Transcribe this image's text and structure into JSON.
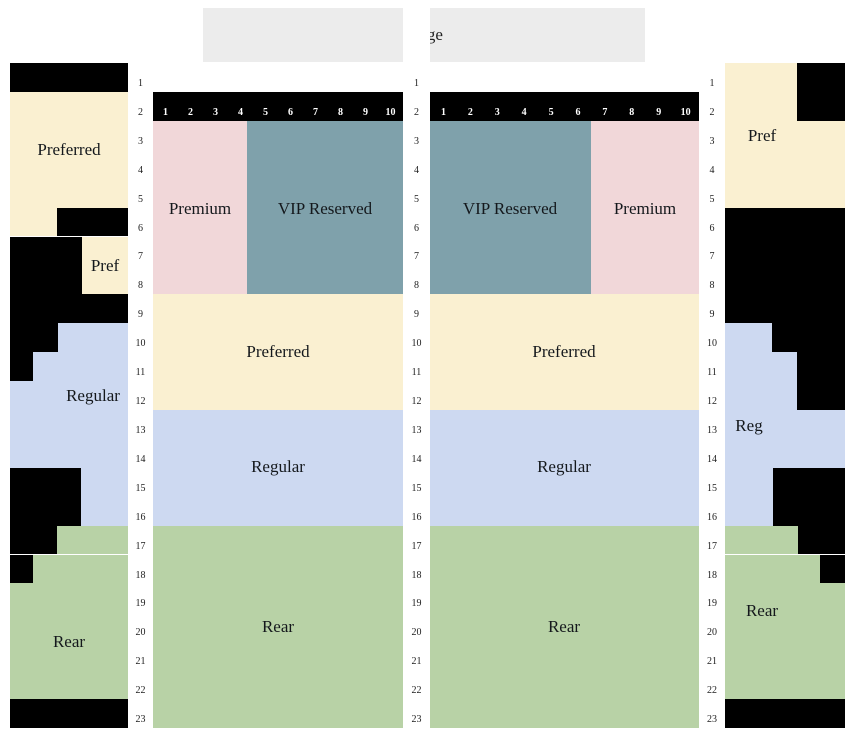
{
  "stage": {
    "label": "Stage"
  },
  "colors": {
    "preferred": "#faf0d1",
    "premium": "#f1d7d9",
    "vip": "#7fa1ab",
    "regular": "#cdd9f1",
    "rear": "#b8d2a6",
    "stage": "#ececec",
    "unavailable": "#000000"
  },
  "rows": {
    "labels": [
      "1",
      "2",
      "3",
      "4",
      "5",
      "6",
      "7",
      "8",
      "9",
      "10",
      "11",
      "12",
      "13",
      "14",
      "15",
      "16",
      "17",
      "18",
      "19",
      "20",
      "21",
      "22",
      "23"
    ]
  },
  "seat_numbers": [
    "1",
    "2",
    "3",
    "4",
    "5",
    "6",
    "7",
    "8",
    "9",
    "10"
  ],
  "sections": {
    "left_side": {
      "preferred": "Preferred",
      "pref": "Pref",
      "regular": "Regular",
      "rear": "Rear"
    },
    "center_left": {
      "premium": "Premium",
      "vip": "VIP Reserved",
      "preferred": "Preferred",
      "regular": "Regular",
      "rear": "Rear"
    },
    "center_right": {
      "vip": "VIP Reserved",
      "premium": "Premium",
      "preferred": "Preferred",
      "regular": "Regular",
      "rear": "Rear"
    },
    "right_side": {
      "pref": "Pref",
      "reg": "Reg",
      "rear": "Rear"
    }
  }
}
